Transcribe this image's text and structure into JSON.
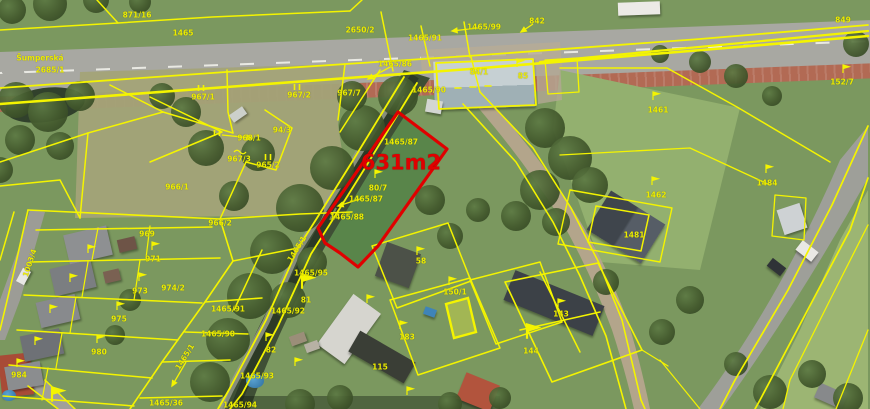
{
  "map": {
    "street_name": "Šumperská",
    "highlight": {
      "area_label": "631m2",
      "color": "#e00000"
    },
    "colors": {
      "boundary_line": "#f4f400",
      "label_text": "#ecec00",
      "highlight": "#e00000"
    },
    "labels": [
      {
        "t": "871/16",
        "x": 137,
        "y": 15
      },
      {
        "t": "1465",
        "x": 183,
        "y": 33
      },
      {
        "t": "Šumperská",
        "x": 40,
        "y": 58
      },
      {
        "t": "2685/1",
        "x": 50,
        "y": 70
      },
      {
        "t": "2650/2",
        "x": 360,
        "y": 30
      },
      {
        "t": "1465/99",
        "x": 484,
        "y": 27
      },
      {
        "t": "842",
        "x": 537,
        "y": 21
      },
      {
        "t": "1465/91",
        "x": 425,
        "y": 38
      },
      {
        "t": "1465/86",
        "x": 395,
        "y": 64
      },
      {
        "t": "84/1",
        "x": 479,
        "y": 72
      },
      {
        "t": "85",
        "x": 523,
        "y": 76
      },
      {
        "t": "967/7",
        "x": 349,
        "y": 93
      },
      {
        "t": "1465/90",
        "x": 429,
        "y": 90
      },
      {
        "t": "1465/87",
        "x": 401,
        "y": 142
      },
      {
        "t": "631m2",
        "x": 401,
        "y": 163,
        "c": "#e00000",
        "s": 21,
        "b": true
      },
      {
        "t": "80/7",
        "x": 378,
        "y": 188
      },
      {
        "t": "1465/87",
        "x": 366,
        "y": 199
      },
      {
        "t": "1465/88",
        "x": 347,
        "y": 217
      },
      {
        "t": "967/1",
        "x": 203,
        "y": 97
      },
      {
        "t": "967/2",
        "x": 299,
        "y": 95
      },
      {
        "t": "94/3",
        "x": 282,
        "y": 130
      },
      {
        "t": "968/1",
        "x": 249,
        "y": 138
      },
      {
        "t": "967/3",
        "x": 239,
        "y": 159
      },
      {
        "t": "965/2",
        "x": 268,
        "y": 165
      },
      {
        "t": "966/1",
        "x": 177,
        "y": 187
      },
      {
        "t": "966/2",
        "x": 220,
        "y": 223
      },
      {
        "t": "969",
        "x": 147,
        "y": 234
      },
      {
        "t": "971",
        "x": 153,
        "y": 259
      },
      {
        "t": "974/2",
        "x": 173,
        "y": 288
      },
      {
        "t": "973",
        "x": 140,
        "y": 291
      },
      {
        "t": "975",
        "x": 119,
        "y": 319
      },
      {
        "t": "980",
        "x": 99,
        "y": 352
      },
      {
        "t": "984",
        "x": 19,
        "y": 375
      },
      {
        "t": "1003/4",
        "x": 30,
        "y": 263,
        "r": -72
      },
      {
        "t": "1465/95",
        "x": 311,
        "y": 273
      },
      {
        "t": "1465/92",
        "x": 288,
        "y": 311
      },
      {
        "t": "1465/91",
        "x": 228,
        "y": 309
      },
      {
        "t": "1465/90",
        "x": 218,
        "y": 334
      },
      {
        "t": "1465/93",
        "x": 257,
        "y": 376
      },
      {
        "t": "1465/36",
        "x": 166,
        "y": 403
      },
      {
        "t": "1465/94",
        "x": 240,
        "y": 405
      },
      {
        "t": "1465/1",
        "x": 297,
        "y": 249,
        "r": -58
      },
      {
        "t": "1465/1",
        "x": 185,
        "y": 357,
        "r": -58
      },
      {
        "t": "81",
        "x": 306,
        "y": 300
      },
      {
        "t": "82",
        "x": 271,
        "y": 350
      },
      {
        "t": "58",
        "x": 421,
        "y": 261
      },
      {
        "t": "183",
        "x": 407,
        "y": 337
      },
      {
        "t": "115",
        "x": 380,
        "y": 367
      },
      {
        "t": "150/1",
        "x": 455,
        "y": 292
      },
      {
        "t": "143",
        "x": 561,
        "y": 314
      },
      {
        "t": "144",
        "x": 531,
        "y": 351
      },
      {
        "t": "1481",
        "x": 634,
        "y": 235
      },
      {
        "t": "1461",
        "x": 658,
        "y": 110
      },
      {
        "t": "1462",
        "x": 656,
        "y": 195
      },
      {
        "t": "1484",
        "x": 767,
        "y": 183
      },
      {
        "t": "152/7",
        "x": 842,
        "y": 82
      },
      {
        "t": "849",
        "x": 843,
        "y": 20
      }
    ],
    "symbols": {
      "flags": [
        {
          "x": 517,
          "y": 66
        },
        {
          "x": 375,
          "y": 177
        },
        {
          "x": 152,
          "y": 249
        },
        {
          "x": 139,
          "y": 280
        },
        {
          "x": 117,
          "y": 309
        },
        {
          "x": 97,
          "y": 342
        },
        {
          "x": 88,
          "y": 252
        },
        {
          "x": 70,
          "y": 281
        },
        {
          "x": 50,
          "y": 312
        },
        {
          "x": 35,
          "y": 344
        },
        {
          "x": 17,
          "y": 366
        },
        {
          "x": 266,
          "y": 340
        },
        {
          "x": 367,
          "y": 302
        },
        {
          "x": 400,
          "y": 328
        },
        {
          "x": 417,
          "y": 254
        },
        {
          "x": 449,
          "y": 284
        },
        {
          "x": 558,
          "y": 306
        },
        {
          "x": 653,
          "y": 99
        },
        {
          "x": 652,
          "y": 184
        },
        {
          "x": 766,
          "y": 172
        },
        {
          "x": 843,
          "y": 72
        },
        {
          "x": 407,
          "y": 394
        },
        {
          "x": 295,
          "y": 365
        },
        {
          "x": 302,
          "y": 287,
          "big": true
        },
        {
          "x": 527,
          "y": 337,
          "big": true
        },
        {
          "x": 52,
          "y": 400,
          "big": true
        }
      ],
      "meadow_marks": [
        {
          "x": 201,
          "y": 88
        },
        {
          "x": 297,
          "y": 87
        },
        {
          "x": 217,
          "y": 133
        },
        {
          "x": 268,
          "y": 157
        }
      ],
      "water_marks": [
        {
          "x": 240,
          "y": 152
        }
      ],
      "arrows": [
        {
          "x1": 478,
          "y1": 28,
          "x2": 452,
          "y2": 31
        },
        {
          "x1": 533,
          "y1": 24,
          "x2": 521,
          "y2": 32
        },
        {
          "x1": 392,
          "y1": 66,
          "x2": 368,
          "y2": 79
        },
        {
          "x1": 222,
          "y1": 135,
          "x2": 252,
          "y2": 138
        },
        {
          "x1": 360,
          "y1": 199,
          "x2": 338,
          "y2": 206
        },
        {
          "x1": 186,
          "y1": 362,
          "x2": 172,
          "y2": 386
        }
      ]
    }
  }
}
